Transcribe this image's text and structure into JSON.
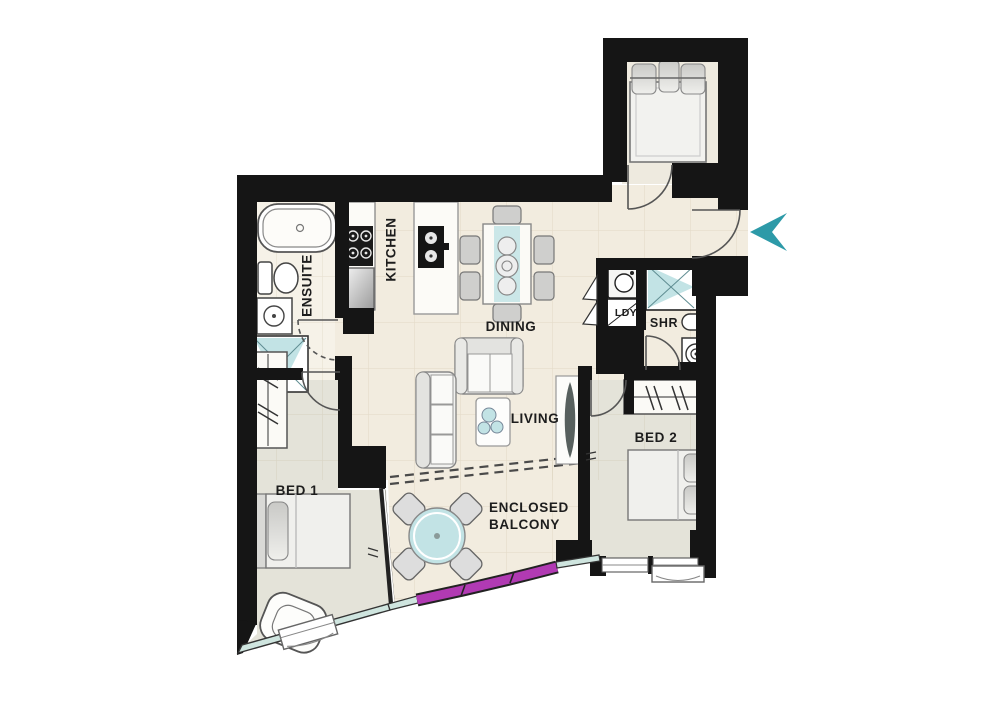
{
  "plan": {
    "type": "apartment-floor-plan",
    "rooms": {
      "ensuite": {
        "label": "ENSUITE"
      },
      "kitchen": {
        "label": "KITCHEN"
      },
      "dining": {
        "label": "DINING"
      },
      "living": {
        "label": "LIVING"
      },
      "bed1": {
        "label": "BED 1"
      },
      "bed2": {
        "label": "BED 2"
      },
      "balcony": {
        "label": "ENCLOSED BALCONY"
      },
      "laundry": {
        "label": "LDY"
      },
      "shower": {
        "label": "SHR"
      }
    },
    "markers": {
      "entry_arrow_icon": "left-chevron"
    }
  },
  "colors": {
    "page-bg": "#ffffff",
    "wall": "#151515",
    "floor-main": "#f2ecdf",
    "floor-ensuite": "#f6f2e8",
    "floor-room": "#e4e3d9",
    "floor-top-room": "#eeeadf",
    "accent-teal": "#2d9aa8",
    "teal-light": "#c2e3e5",
    "window-teal": "#cfe5df",
    "window-magenta": "#b13ab3",
    "line": "#555555",
    "furniture-fill": "#f1f1ef",
    "furniture-dark": "#cfcfcd",
    "text": "#1d1d1d"
  }
}
